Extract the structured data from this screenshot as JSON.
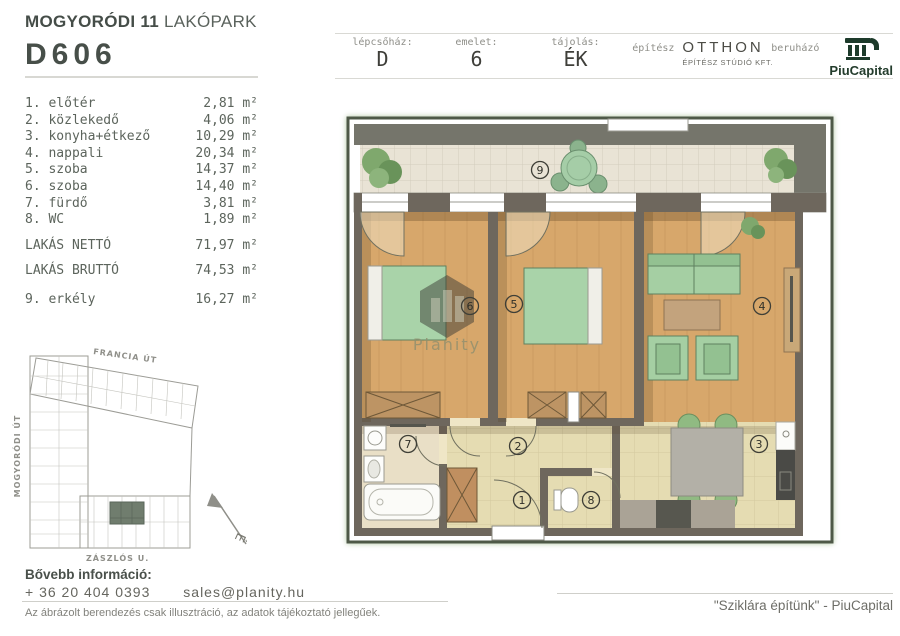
{
  "header": {
    "project_bold": "MOGYORÓDI 11",
    "project_light": "LAKÓPARK",
    "unit_id": "D606",
    "info": [
      {
        "label": "lépcsőház:",
        "value": "D"
      },
      {
        "label": "emelet:",
        "value": "6"
      },
      {
        "label": "tájolás:",
        "value": "ÉK"
      }
    ],
    "architect_label": "építész",
    "architect_name": "OTTHON",
    "architect_sub": "ÉPÍTÉSZ STÚDIÓ KFT.",
    "developer_label": "beruházó",
    "developer_name": "PiuCapital"
  },
  "rooms": [
    {
      "num": "1.",
      "name": "előtér",
      "area": "2,81 m²"
    },
    {
      "num": "2.",
      "name": "közlekedő",
      "area": "4,06 m²"
    },
    {
      "num": "3.",
      "name": "konyha+étkező",
      "area": "10,29 m²"
    },
    {
      "num": "4.",
      "name": "nappali",
      "area": "20,34 m²"
    },
    {
      "num": "5.",
      "name": "szoba",
      "area": "14,37 m²"
    },
    {
      "num": "6.",
      "name": "szoba",
      "area": "14,40 m²"
    },
    {
      "num": "7.",
      "name": "fürdő",
      "area": "3,81 m²"
    },
    {
      "num": "8.",
      "name": "WC",
      "area": "1,89 m²"
    }
  ],
  "totals": [
    {
      "label": "LAKÁS NETTÓ",
      "area": "71,97 m²"
    },
    {
      "label": "LAKÁS BRUTTÓ",
      "area": "74,53 m²"
    }
  ],
  "balcony_row": {
    "num": "9.",
    "name": "erkély",
    "area": "16,27 m²"
  },
  "floor_plan": {
    "badges": [
      "1",
      "2",
      "3",
      "4",
      "5",
      "6",
      "7",
      "8",
      "9"
    ],
    "watermark": "Planity",
    "colors": {
      "wall": "#6e675d",
      "wood": "#d7a76b",
      "beige": "#e5dcb2",
      "tile": "#e9e3d5",
      "green_furniture": "#a9d3a9",
      "frame": "#4e5947"
    }
  },
  "site_plan": {
    "street_top": "FRANCIA ÚT",
    "street_left": "MOGYORÓDI ÚT",
    "street_bottom": "ZÁSZLÓS U.",
    "north_letter": "É"
  },
  "footer": {
    "info_heading": "Bővebb információ:",
    "phone": "+ 36 20 404 0393",
    "email": "sales@planity.hu",
    "disclaimer": "Az ábrázolt berendezés csak illusztráció, az adatok tájékoztató jellegűek.",
    "tagline": "\"Sziklára építünk\" - PiuCapital"
  }
}
